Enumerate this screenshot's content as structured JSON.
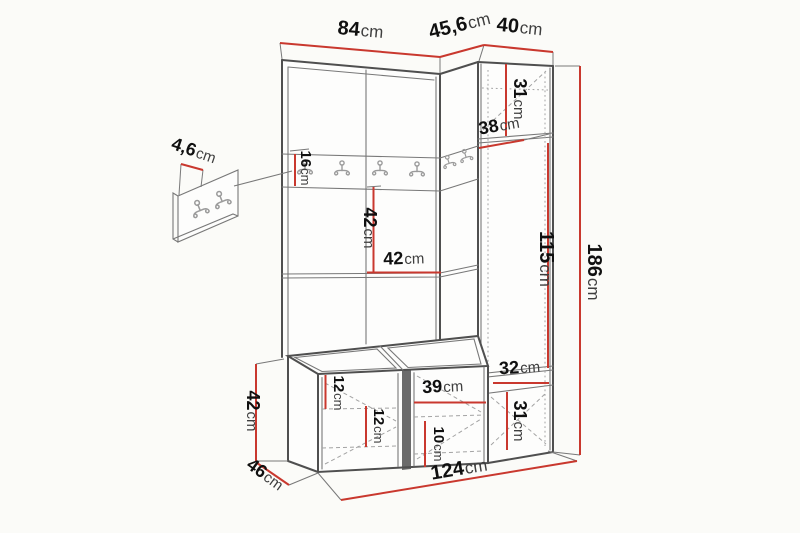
{
  "diagram": {
    "kind": "furniture-dimension-diagram",
    "unit": "cm"
  },
  "colors": {
    "background": "#fbfbf8",
    "face_fill": "#fdfdfc",
    "dimension_line": "#c9382e",
    "furniture_outline": "#4f4f4f",
    "furniture_detail": "#787878",
    "dashed_detail": "#a3a3a3",
    "hook": "#9b9b9b",
    "label_number": "#101010",
    "gap_fill": "#6b6b6b"
  },
  "dims": {
    "top_width": {
      "num": "84",
      "unit": "cm"
    },
    "corner_width": {
      "num": "45,6",
      "unit": "cm"
    },
    "right_width": {
      "num": "40",
      "unit": "cm"
    },
    "hook_panel_thickness": {
      "num": "4,6",
      "unit": "cm"
    },
    "rail_height": {
      "num": "16",
      "unit": "cm"
    },
    "niche_height": {
      "num": "42",
      "unit": "cm"
    },
    "niche_width": {
      "num": "42",
      "unit": "cm"
    },
    "cab_top_height": {
      "num": "31",
      "unit": "cm"
    },
    "cab_depth": {
      "num": "38",
      "unit": "cm"
    },
    "cab_door_height": {
      "num": "115",
      "unit": "cm"
    },
    "total_height": {
      "num": "186",
      "unit": "cm"
    },
    "cab_niche_width": {
      "num": "32",
      "unit": "cm"
    },
    "cab_bottom_height": {
      "num": "31",
      "unit": "cm"
    },
    "bench_height": {
      "num": "42",
      "unit": "cm"
    },
    "bench_depth": {
      "num": "46",
      "unit": "cm"
    },
    "bench_gap_top": {
      "num": "12",
      "unit": "cm"
    },
    "bench_gap_bottom": {
      "num": "12",
      "unit": "cm"
    },
    "bench_door_width": {
      "num": "39",
      "unit": "cm"
    },
    "bench_gap_right": {
      "num": "10",
      "unit": "cm"
    },
    "total_width": {
      "num": "124",
      "unit": "cm"
    }
  }
}
